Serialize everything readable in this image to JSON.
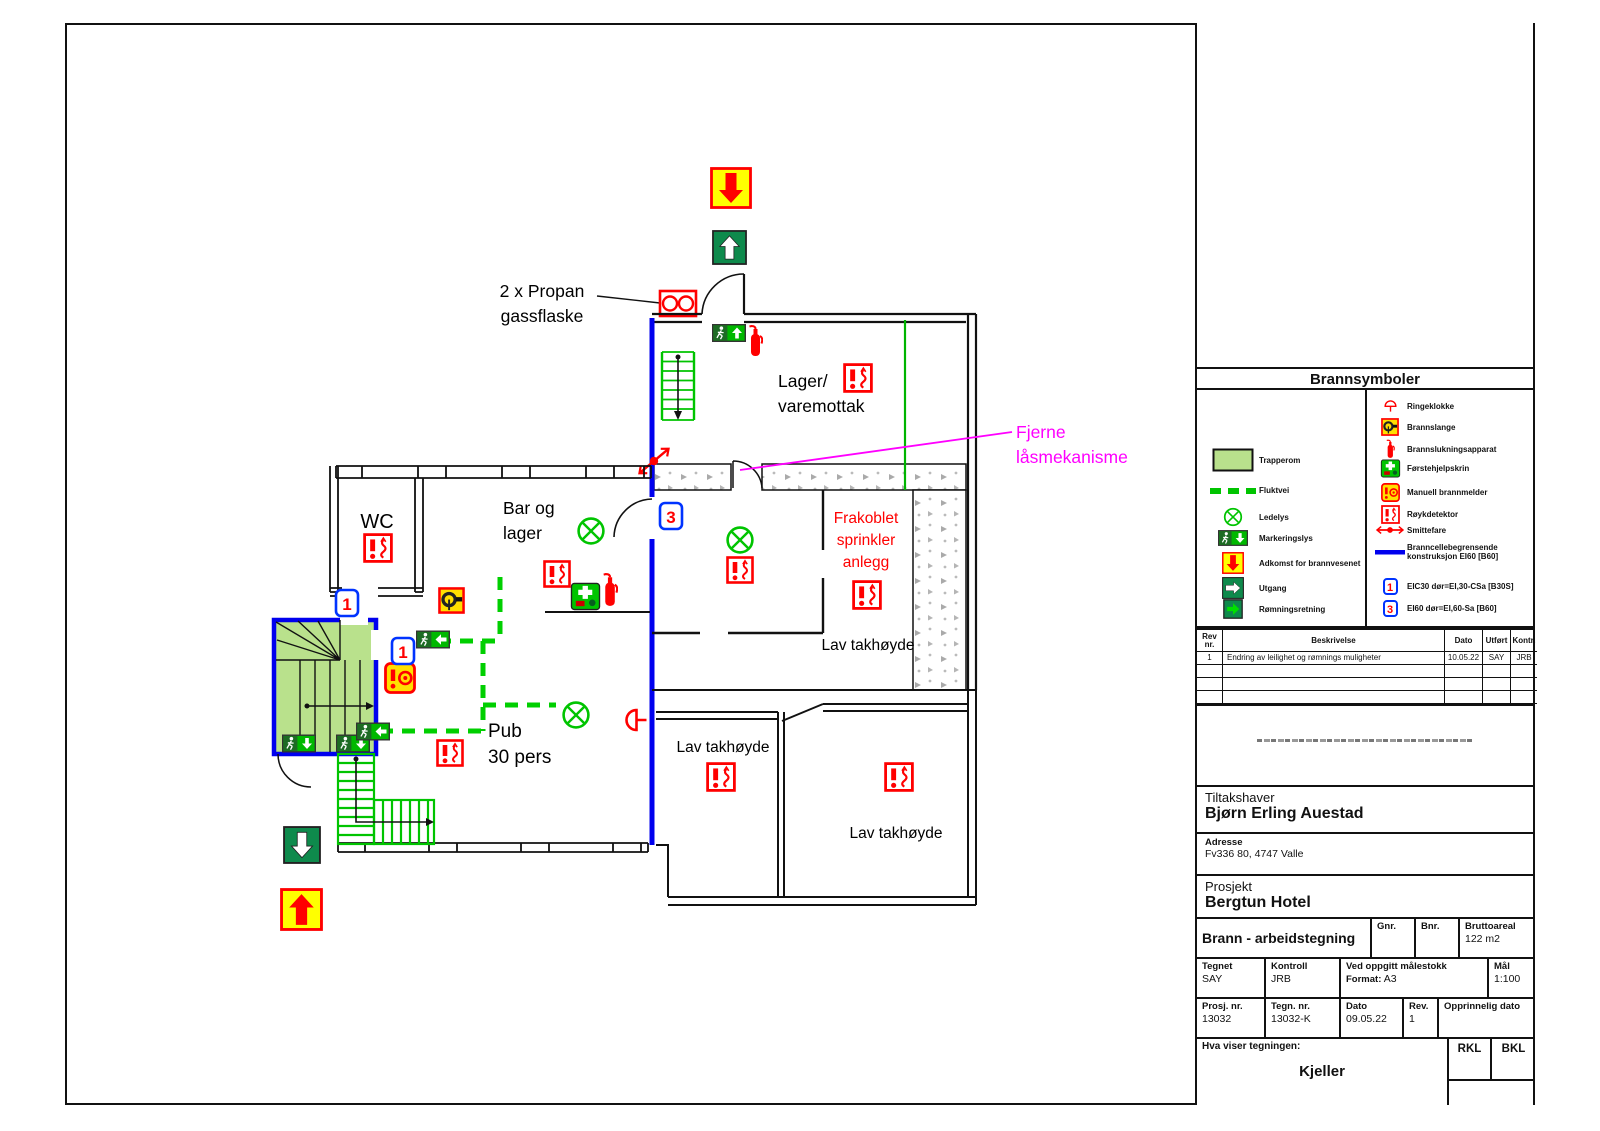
{
  "plan": {
    "labels": {
      "propane_1": "2 x Propan",
      "propane_2": "gassflaske",
      "lager_1": "Lager/",
      "lager_2": "varemottak",
      "fjerne_1": "Fjerne",
      "fjerne_2": "låsmekanisme",
      "frakoblet_1": "Frakoblet",
      "frakoblet_2": "sprinkler",
      "frakoblet_3": "anlegg",
      "wc": "WC",
      "bar_1": "Bar og",
      "bar_2": "lager",
      "pub_1": "Pub",
      "pub_2": "30 pers",
      "lav_takhoyde": "Lav takhøyde",
      "door_class_1": "1",
      "door_class_3": "3"
    },
    "colors": {
      "escape_green": "#00c400",
      "firewall_blue": "#0000ee",
      "alert_red": "#ff0000",
      "note_magenta": "#ff00ff",
      "stair_fill": "#b9e18c",
      "access_yellow": "#ffff00",
      "exit_green": "#0e8a4c"
    }
  },
  "legend": {
    "title": "Brannsymboler",
    "left": [
      {
        "icon": "trapperom-swatch",
        "label": "Trapperom"
      },
      {
        "icon": "fluktvei-dash",
        "label": "Fluktvei"
      },
      {
        "icon": "ledelys",
        "label": "Ledelys"
      },
      {
        "icon": "markeringslys",
        "label": "Markeringslys"
      },
      {
        "icon": "adkomst",
        "label": "Adkomst for brannvesenet"
      },
      {
        "icon": "utgang",
        "label": "Utgang"
      },
      {
        "icon": "romningsretning",
        "label": "Rømningsretning"
      }
    ],
    "right": [
      {
        "icon": "ringeklokke",
        "label": "Ringeklokke"
      },
      {
        "icon": "brannslange",
        "label": "Brannslange"
      },
      {
        "icon": "brannslukningsapparat",
        "label": "Brannslukningsapparat"
      },
      {
        "icon": "forstehjelpskrin",
        "label": "Førstehjelpskrin"
      },
      {
        "icon": "manuell-brannmelder",
        "label": "Manuell brannmelder"
      },
      {
        "icon": "roykdetektor",
        "label": "Røykdetektor"
      },
      {
        "icon": "smittefare",
        "label": "Smittefare"
      },
      {
        "icon": "branncelle-linje",
        "label": "Branncellebegrensende konstruksjon EI60 [B60]"
      }
    ],
    "doors": [
      {
        "num": "1",
        "label": "EIC30 dør=EI,30-CSa [B30S]"
      },
      {
        "num": "3",
        "label": "EI60 dør=EI,60-Sa [B60]"
      }
    ]
  },
  "revisions": {
    "headers": {
      "rev": "Rev nr.",
      "beskrivelse": "Beskrivelse",
      "dato": "Dato",
      "utfort": "Utført",
      "kontr": "Kontr."
    },
    "rows": [
      {
        "rev": "1",
        "beskrivelse": "Endring av leilighet og rømnings muligheter",
        "dato": "10.05.22",
        "utfort": "SAY",
        "kontr": "JRB"
      }
    ]
  },
  "titleblock": {
    "tiltakshaver_label": "Tiltakshaver",
    "tiltakshaver": "Bjørn Erling Auestad",
    "adresse_label": "Adresse",
    "adresse": "Fv336 80, 4747 Valle",
    "prosjekt_label": "Prosjekt",
    "prosjekt": "Bergtun Hotel",
    "tegning_type": "Brann - arbeidstegning",
    "gnr_label": "Gnr.",
    "bnr_label": "Bnr.",
    "bruttoareal_label": "Bruttoareal",
    "bruttoareal": "122 m2",
    "tegnet_label": "Tegnet",
    "tegnet": "SAY",
    "kontroll_label": "Kontroll",
    "kontroll": "JRB",
    "malestokk_label": "Ved oppgitt målestokk",
    "format_label": "Format:",
    "format": "A3",
    "mal_label": "Mål",
    "mal": "1:100",
    "prosjnr_label": "Prosj. nr.",
    "prosjnr": "13032",
    "tegnnr_label": "Tegn. nr.",
    "tegnnr": "13032-K",
    "dato_label": "Dato",
    "dato": "09.05.22",
    "rev_label": "Rev.",
    "rev": "1",
    "opprinnelig_label": "Opprinnelig dato",
    "hva_label": "Hva viser tegningen:",
    "hva": "Kjeller",
    "rkl": "RKL",
    "bkl": "BKL"
  }
}
